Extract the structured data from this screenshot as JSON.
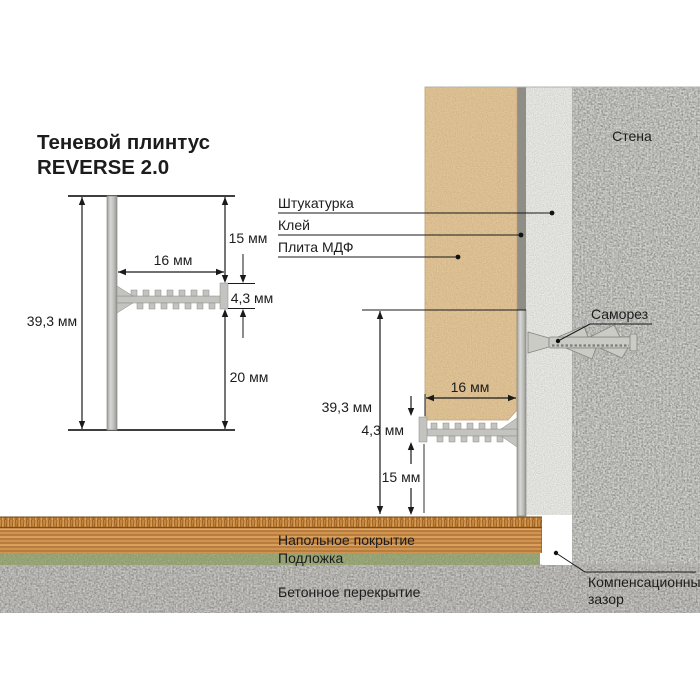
{
  "title": {
    "line1": "Теневой плинтус",
    "line2": "REVERSE 2.0"
  },
  "profile_drawing": {
    "overall_height": "39,3 мм",
    "flange_width": "16 мм",
    "top_offset": "15 мм",
    "flange_thickness": "4,3 мм",
    "bottom_offset": "20 мм"
  },
  "installation_drawing": {
    "wall_label": "Стена",
    "plaster_label": "Штукатурка",
    "glue_label": "Клей",
    "mdf_label": "Плита МДФ",
    "screw_label": "Саморез",
    "overall_height": "39,3 мм",
    "flange_width": "16 мм",
    "flange_thickness": "4,3 мм",
    "floor_clearance": "15 мм",
    "floor_covering_label": "Напольное покрытие",
    "underlay_label": "Подложка",
    "slab_label": "Бетонное перекрытие",
    "expansion_gap_line1": "Компенсационный",
    "expansion_gap_line2": "зазор"
  },
  "colors": {
    "mdf": "#e2c79d",
    "plaster": "#ebebe7",
    "glue": "#8e8e87",
    "aluminum": "#c3c3bf",
    "wall": "#d2d2ce",
    "slab": "#c9c8c4",
    "wood": "#cf9452",
    "underlay": "#a9b488",
    "line": "#1a1a1a"
  }
}
